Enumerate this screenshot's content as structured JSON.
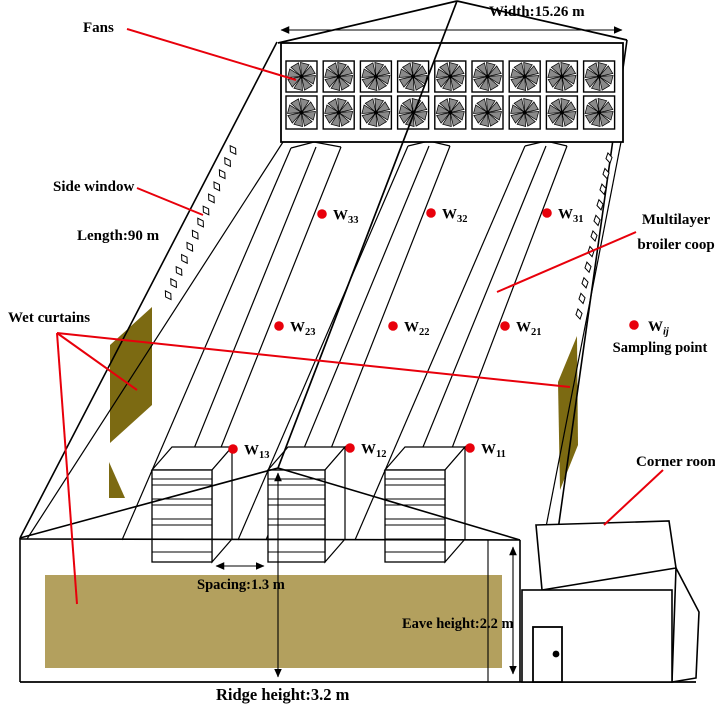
{
  "labels": {
    "fans": "Fans",
    "width": "Width:15.26 m",
    "side_window": "Side window",
    "length": "Length:90 m",
    "wet_curtains": "Wet curtains",
    "multilayer_1": "Multilayer",
    "multilayer_2": "broiler coop",
    "corner_room": "Corner room",
    "spacing": "Spacing:1.3 m",
    "eave_height": "Eave height:2.2 m",
    "ridge_height": "Ridge height:3.2 m"
  },
  "legend": {
    "symbol": "W",
    "subscript": "ij",
    "caption": "Sampling point"
  },
  "sampling_points": [
    {
      "label": "W",
      "sub": "33",
      "x": 322,
      "y": 214
    },
    {
      "label": "W",
      "sub": "32",
      "x": 431,
      "y": 213
    },
    {
      "label": "W",
      "sub": "31",
      "x": 547,
      "y": 213
    },
    {
      "label": "W",
      "sub": "23",
      "x": 279,
      "y": 326
    },
    {
      "label": "W",
      "sub": "22",
      "x": 393,
      "y": 326
    },
    {
      "label": "W",
      "sub": "21",
      "x": 505,
      "y": 326
    },
    {
      "label": "W",
      "sub": "13",
      "x": 233,
      "y": 449
    },
    {
      "label": "W",
      "sub": "12",
      "x": 350,
      "y": 448
    },
    {
      "label": "W",
      "sub": "11",
      "x": 470,
      "y": 448
    }
  ],
  "fans": {
    "rows": 2,
    "cols": 9
  },
  "side_windows": {
    "left_count": 13,
    "right_count": 11
  },
  "colors": {
    "red": "#e8000b",
    "olive": "#7c6a12",
    "tan": "#b3a05e",
    "fan_blade": "#8a8a8a",
    "line": "#000000"
  }
}
